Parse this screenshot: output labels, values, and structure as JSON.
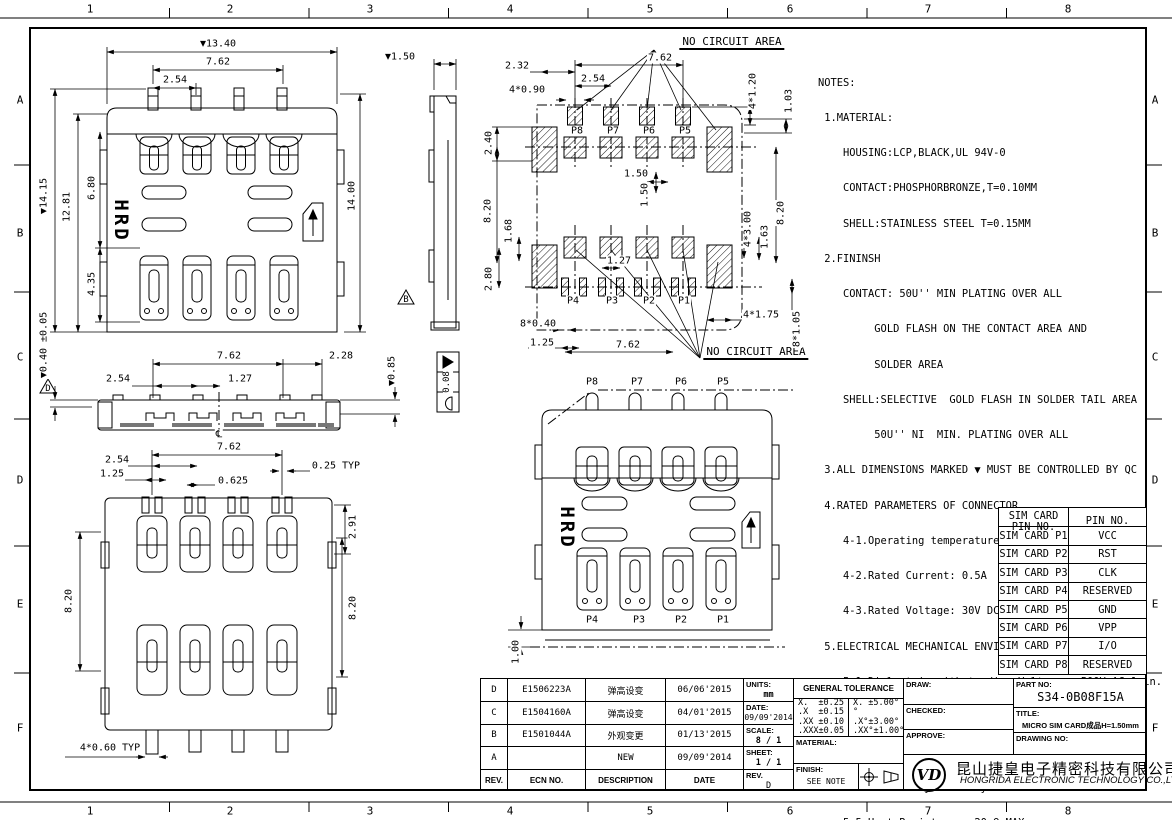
{
  "colors": {
    "ink": "#000000",
    "paper": "#ffffff",
    "strip_gray": "#777777"
  },
  "sheet": {
    "cols": [
      "1",
      "2",
      "3",
      "4",
      "5",
      "6",
      "7",
      "8"
    ],
    "rows": [
      "A",
      "B",
      "C",
      "D",
      "E",
      "F"
    ]
  },
  "notes": {
    "lines": [
      "NOTES:",
      " 1.MATERIAL:",
      "    HOUSING:LCP,BLACK,UL 94V-0",
      "    CONTACT:PHOSPHORBRONZE,T=0.10MM",
      "    SHELL:STAINLESS STEEL T=0.15MM",
      " 2.FININSH",
      "    CONTACT: 50U'' MIN PLATING OVER ALL",
      "         GOLD FLASH ON THE CONTACT AREA AND",
      "         SOLDER AREA",
      "    SHELL:SELECTIVE  GOLD FLASH IN SOLDER TAIL AREA",
      "         50U'' NI  MIN. PLATING OVER ALL",
      " 3.ALL DIMENSIONS MARKED ▼ MUST BE CONTROLLED BY QC",
      " 4.RATED PARAMETERS OF CONNECTOR",
      "    4-1.Operating temperature: -40℃  to 70℃",
      "    4-2.Rated Current: 0.5A",
      "    4-3.Rated Voltage: 30V DC Per Contact",
      " 5.ELECTRICAL MECHANICAL ENVIRONMENTAL",
      "    5-1.Dielectric withstanding Voltage : 500V AC 1min.",
      "    5-2.Insulation Resistance: 1000 MΩMin.",
      "    5-3.Normal  Force: 100g  Min. Per Pin",
      "    5-4.Durability: 1000 cycles",
      "    5-5.Heat Resistance: 20mΩ MAX."
    ]
  },
  "views": {
    "front": {
      "hrd": "HRD",
      "dims": {
        "width": "▼13.40",
        "pin_span": "7.62",
        "pitch": "2.54",
        "height": "▼14.15",
        "h_inner": "12.81",
        "h_upper": "6.80",
        "h_lower": "4.35",
        "height_right": "14.00"
      }
    },
    "side": {
      "dims": {
        "thickness": "▼1.50",
        "flatness": "0.08",
        "datum": "B"
      }
    },
    "profile": {
      "dims": {
        "span": "7.62",
        "right": "2.28",
        "pitch": "2.54",
        "half_pitch": "1.27",
        "standoff": "▼0.40 ±0.05",
        "height": "▼0.85",
        "datum": "D",
        "centerline": "℄"
      }
    },
    "bottom": {
      "dims": {
        "span": "7.62",
        "pitch": "2.54",
        "edge": "1.25",
        "half": "0.625",
        "typ": "0.25 TYP",
        "corner": "2.91",
        "left": "8.20",
        "right": "8.20",
        "tails": "4*0.60 TYP"
      }
    },
    "pcb": {
      "no_circuit_top": "NO CIRCUIT AREA",
      "no_circuit_bottom": "NO CIRCUIT AREA",
      "pads_top": [
        "P8",
        "P7",
        "P6",
        "P5"
      ],
      "pads_bottom": [
        "P4",
        "P3",
        "P2",
        "P1"
      ],
      "dims": {
        "edge": "2.32",
        "span_top": "7.62",
        "pitch": "2.54",
        "pad_w": "4*0.90",
        "pad_h": "4*1.20",
        "offset": "1.03",
        "edge_left": "2.40",
        "gap_h": "1.50",
        "gap_v": "1.50",
        "row_span_left": "8.20",
        "row_offset": "1.68",
        "edge_bottom": "2.80",
        "half_pitch": "1.27",
        "tall_pad_h": "4*3.00",
        "offset2": "1.63",
        "row_span_right": "8.20",
        "tail_pad_w": "4*1.75",
        "tiny_pad_h": "8*1.05",
        "tiny_pad_w": "8*0.40",
        "tiny_offset": "1.25",
        "span_bottom": "7.62"
      }
    },
    "front2": {
      "hrd": "HRD",
      "pins_top": [
        "P8",
        "P7",
        "P6",
        "P5"
      ],
      "pins_bottom": [
        "P4",
        "P3",
        "P2",
        "P1"
      ],
      "dims": {
        "standoff": "1.00"
      }
    }
  },
  "pin_table": {
    "header_left_line1": "SIM CARD",
    "header_left_line2": "PIN NO.",
    "header_right": "PIN NO.",
    "rows": [
      {
        "pin": "SIM CARD P1",
        "signal": "VCC"
      },
      {
        "pin": "SIM CARD P2",
        "signal": "RST"
      },
      {
        "pin": "SIM CARD P3",
        "signal": "CLK"
      },
      {
        "pin": "SIM CARD P4",
        "signal": "RESERVED"
      },
      {
        "pin": "SIM CARD P5",
        "signal": "GND"
      },
      {
        "pin": "SIM CARD P6",
        "signal": "VPP"
      },
      {
        "pin": "SIM CARD P7",
        "signal": "I/O"
      },
      {
        "pin": "SIM CARD P8",
        "signal": "RESERVED"
      }
    ]
  },
  "revisions": {
    "headers": [
      "REV.",
      "ECN NO.",
      "DESCRIPTION",
      "DATE"
    ],
    "rows": [
      {
        "rev": "D",
        "ecn": "E1506223A",
        "desc": "弹高设变",
        "date": "06/06'2015"
      },
      {
        "rev": "C",
        "ecn": "E1504160A",
        "desc": "弹高设变",
        "date": "04/01'2015"
      },
      {
        "rev": "B",
        "ecn": "E1501044A",
        "desc": "外观变更",
        "date": "01/13'2015"
      },
      {
        "rev": "A",
        "ecn": "",
        "desc": "NEW",
        "date": "09/09'2014"
      }
    ]
  },
  "title_block": {
    "units_label": "UNITS:",
    "units_value": "mm",
    "date_label": "DATE:",
    "date_value": "09/09'2014",
    "scale_label": "SCALE:",
    "scale_value": "8 / 1",
    "sheet_label": "SHEET:",
    "sheet_value": "1 / 1",
    "rev_label": "REV.",
    "rev_value": "D",
    "tolerance_title": "GENERAL TOLERANCE",
    "tolerance": [
      {
        "range": "X.",
        "value": "±0.25",
        "range_deg": "X.°",
        "value_deg": "±5.00°"
      },
      {
        "range": ".X",
        "value": "±0.15",
        "range_deg": ".X°",
        "value_deg": "±3.00°"
      },
      {
        "range": ".XX",
        "value": "±0.10",
        "range_deg": ".XX°",
        "value_deg": "±1.00°"
      },
      {
        "range": ".XXX",
        "value": "±0.05",
        "range_deg": "",
        "value_deg": ""
      }
    ],
    "material_label": "MATERIAL:",
    "finish_label": "FINISH:",
    "finish_value": "SEE NOTE",
    "draw_label": "DRAW:",
    "checked_label": "CHECKED:",
    "approve_label": "APPROVE:",
    "part_no_label": "PART NO:",
    "part_no_value": "S34-0B08F15A",
    "title_label": "TITLE:",
    "title_value": "MICRO SIM CARD成品H=1.50mm",
    "drawing_no_label": "DRAWING NO:",
    "logo_text": "VD",
    "company_cn": "昆山捷皇电子精密科技有限公司",
    "company_en": "HONGRIDA ELECTRONIC TECHNOLOGY CO.,LTD."
  }
}
